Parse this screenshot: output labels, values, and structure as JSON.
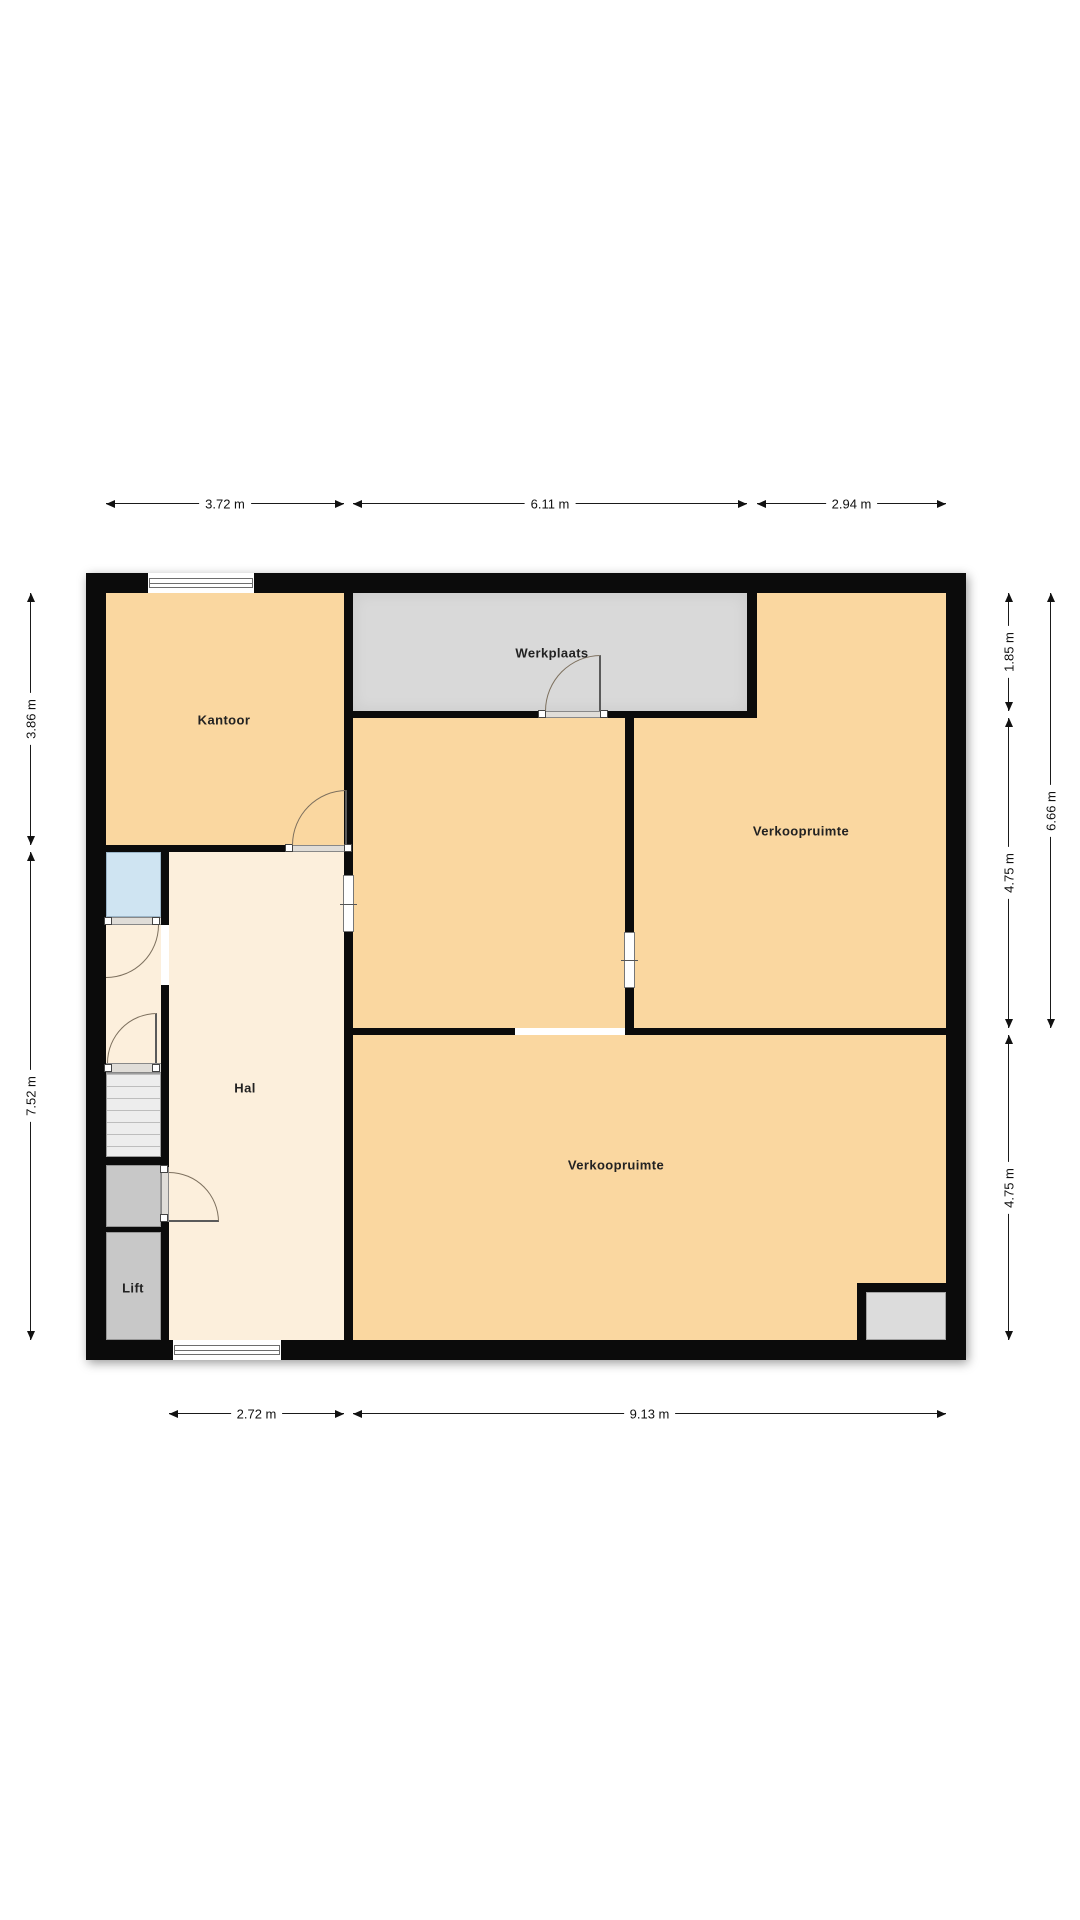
{
  "plan": {
    "rooms": [
      {
        "name": "kantoor",
        "label": "Kantoor"
      },
      {
        "name": "werkplaats",
        "label": "Werkplaats"
      },
      {
        "name": "verkoopruimte-rechts",
        "label": "Verkoopruimte"
      },
      {
        "name": "verkoopruimte-onder",
        "label": "Verkoopruimte"
      },
      {
        "name": "hal",
        "label": "Hal"
      },
      {
        "name": "lift",
        "label": "Lift"
      }
    ],
    "dimensions": {
      "top": [
        {
          "label": "3.72 m"
        },
        {
          "label": "6.11 m"
        },
        {
          "label": "2.94 m"
        }
      ],
      "bottom": [
        {
          "label": "2.72 m"
        },
        {
          "label": "9.13 m"
        }
      ],
      "left": [
        {
          "label": "3.86 m"
        },
        {
          "label": "7.52 m"
        }
      ],
      "right_inner": [
        {
          "label": "1.85 m"
        },
        {
          "label": "4.75 m"
        },
        {
          "label": "4.75 m"
        }
      ],
      "right_outer": [
        {
          "label": "6.66 m"
        }
      ]
    },
    "colors": {
      "room_orange": "#fad7a0",
      "hall_cream": "#fcefdc",
      "workshop_gray": "#d9d9d9",
      "service_gray": "#c8c8c8",
      "stairs_gray": "#ededed",
      "wet_room_blue": "#cfe4f2",
      "wall_black": "#0b0b0b"
    }
  }
}
